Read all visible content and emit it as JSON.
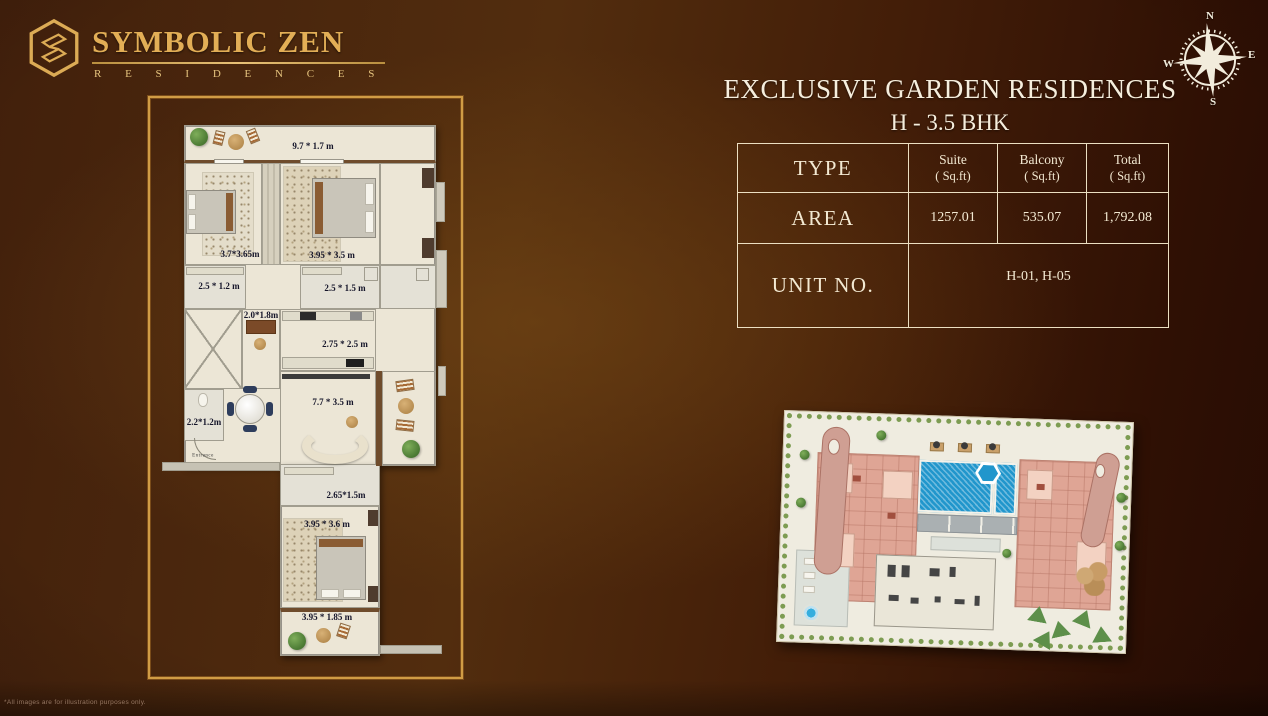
{
  "brand": {
    "name": "SYMBOLIC ZEN",
    "tagline": "R E S I D E N C E S"
  },
  "header": {
    "title_line1": "EXCLUSIVE GARDEN RESIDENCES",
    "title_line2": "H - 3.5 BHK"
  },
  "compass": {
    "n": "N",
    "e": "E",
    "s": "S",
    "w": "W"
  },
  "spec_table": {
    "type_label": "TYPE",
    "headers": [
      {
        "name": "Suite",
        "unit": "( Sq.ft)"
      },
      {
        "name": "Balcony",
        "unit": "( Sq.ft)"
      },
      {
        "name": "Total",
        "unit": "( Sq.ft)"
      }
    ],
    "area_label": "AREA",
    "area_values": [
      "1257.01",
      "535.07",
      "1,792.08"
    ],
    "unit_label": "UNIT NO.",
    "unit_value": "H-01, H-05"
  },
  "floor_plan": {
    "labels": {
      "balcony_top": "9.7 * 1.7 m",
      "bedroom_left": "3.7*3.65m",
      "bedroom_right": "3.95 * 3.5 m",
      "bath_left": "2.5 * 1.2 m",
      "bath_right": "2.5 * 1.5 m",
      "study": "2.0*1.8m",
      "kitchen": "2.75 * 2.5 m",
      "powder": "2.2*1.2m",
      "living": "7.7 * 3.5 m",
      "entrance": "Entrance",
      "bath_lower": "2.65*1.5m",
      "bedroom_lower": "3.95 * 3.6 m",
      "balcony_lower": "3.95 * 1.85 m"
    }
  },
  "footnote": "*All images are for illustration purposes only.",
  "colors": {
    "accent_gold": "#dcab55",
    "table_border": "#ecdfc2",
    "title_text": "#f6eedd",
    "plan_cream": "#ece6d6",
    "pool_blue": "#2196cc",
    "site_pink": "#dfa595",
    "hedge_green": "#7d9c52",
    "background_brown": "#42200c"
  }
}
